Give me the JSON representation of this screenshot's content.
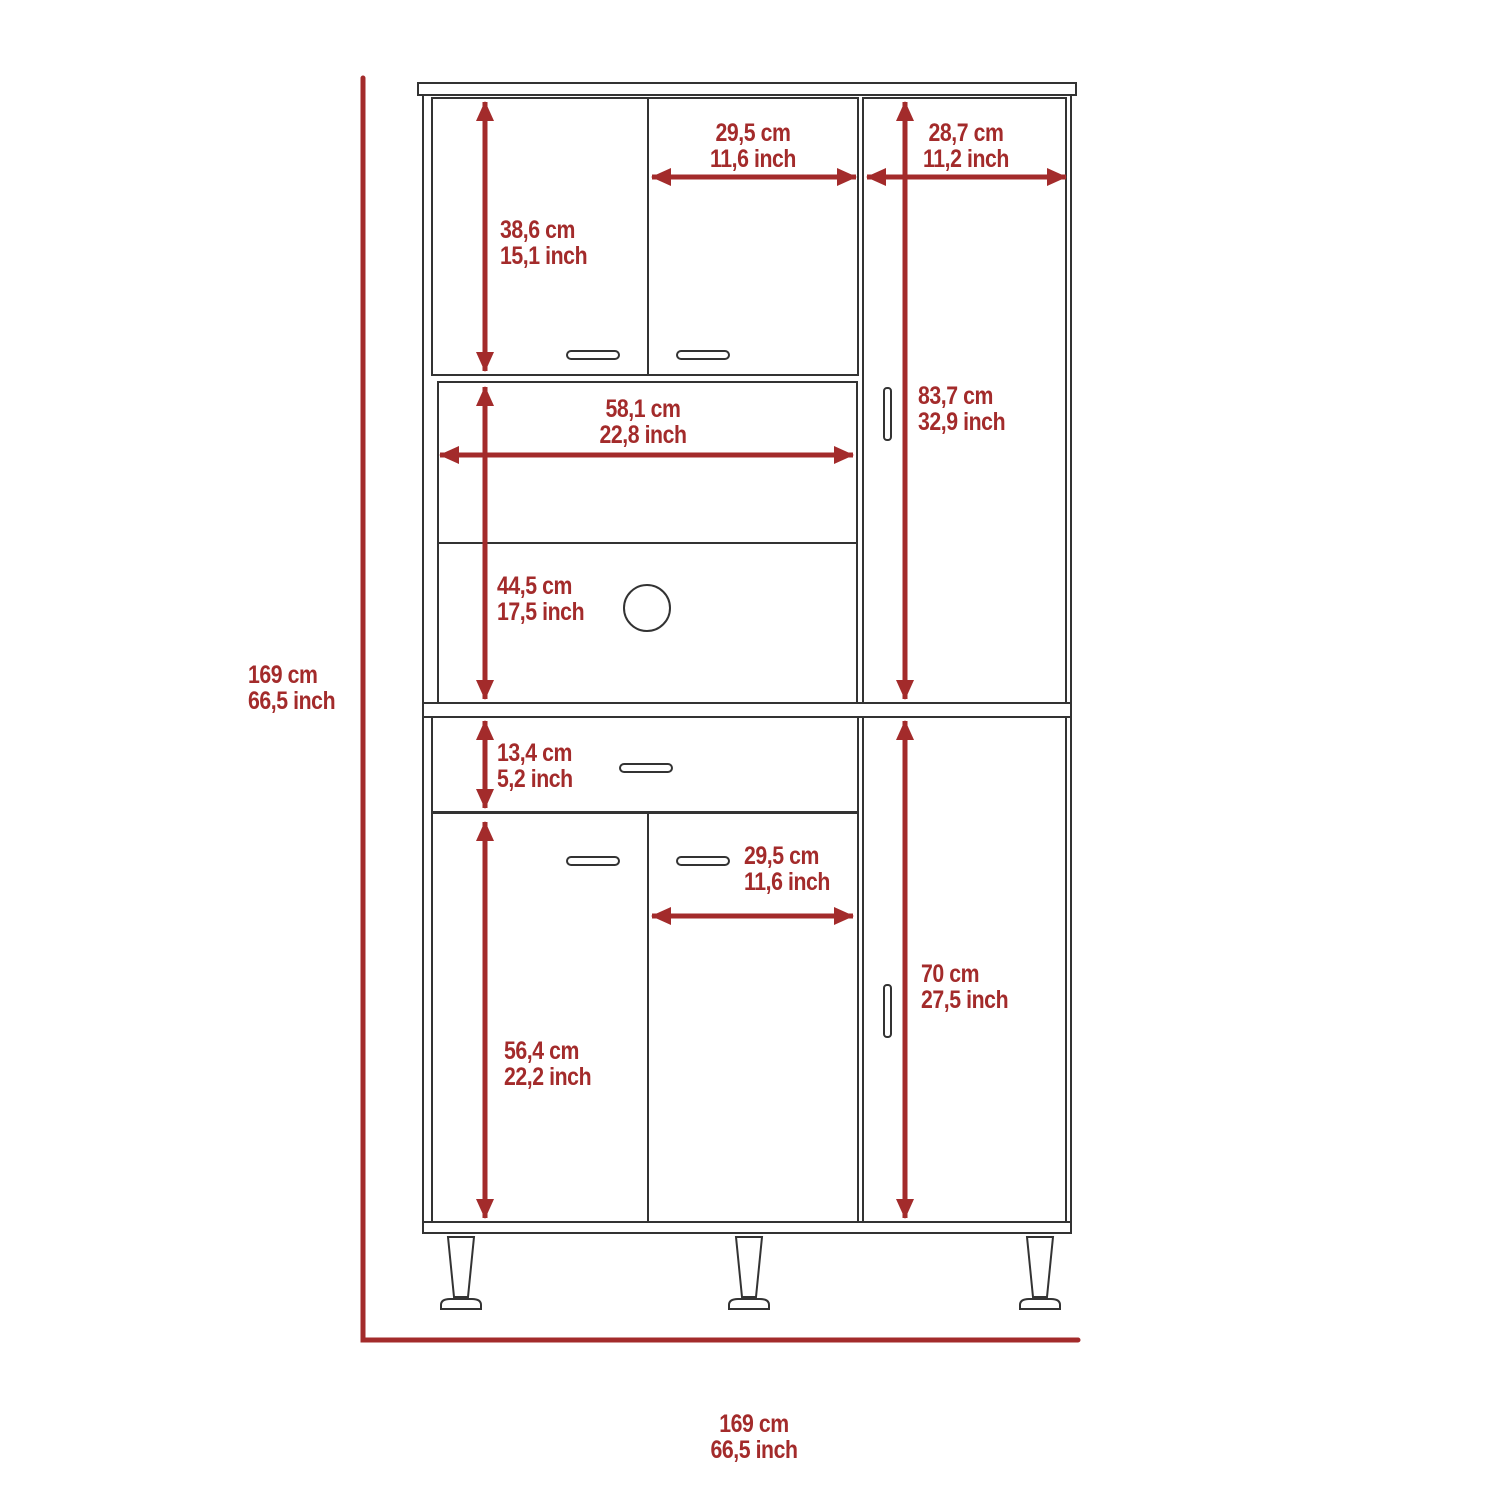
{
  "diagram": {
    "accent_color": "#A32B2B",
    "line_color": "#333333",
    "background_color": "#FFFFFF",
    "overall_height": {
      "cm": "169 cm",
      "inch": "66,5 inch"
    },
    "overall_width": {
      "cm": "169 cm",
      "inch": "66,5 inch"
    },
    "dims": {
      "upper_left_door_height": {
        "cm": "38,6 cm",
        "inch": "15,1 inch"
      },
      "upper_middle_door_width": {
        "cm": "29,5 cm",
        "inch": "11,6 inch"
      },
      "upper_right_section_width": {
        "cm": "28,7 cm",
        "inch": "11,2 inch"
      },
      "upper_right_door_height": {
        "cm": "83,7 cm",
        "inch": "32,9 inch"
      },
      "open_shelf_width": {
        "cm": "58,1 cm",
        "inch": "22,8 inch"
      },
      "open_compartment_height": {
        "cm": "44,5 cm",
        "inch": "17,5 inch"
      },
      "drawer_height": {
        "cm": "13,4 cm",
        "inch": "5,2 inch"
      },
      "lower_left_door_height": {
        "cm": "56,4 cm",
        "inch": "22,2 inch"
      },
      "lower_middle_door_width": {
        "cm": "29,5 cm",
        "inch": "11,6 inch"
      },
      "lower_right_door_height": {
        "cm": "70 cm",
        "inch": "27,5 inch"
      }
    }
  }
}
